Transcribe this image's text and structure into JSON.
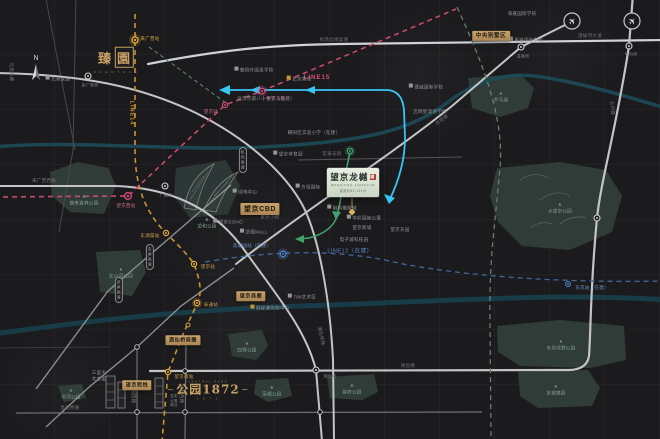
{
  "card": {
    "title": "望京龙樾",
    "eng": "WANGJING LONGYUE",
    "spec": "建面约89-134㎡",
    "seal": "樾"
  },
  "zhen": {
    "c1": "臻",
    "c2": "園",
    "sub": "Z H E N Y U A N"
  },
  "p1872": {
    "top": "CENTRAL PARK",
    "main": "公园1872",
    "sub": "1 8 7 2"
  },
  "compass": {
    "n": "N"
  },
  "colors": {
    "gold": "#c9962e",
    "pink": "#c94a74",
    "blue": "#40699f",
    "sage": "#5e8274",
    "cyan": "#38c5f5",
    "green": "#3fa46a",
    "tag_gold": "#bd9463",
    "brand_gold": "#c9a063",
    "park": "#33403c",
    "river": "#1c4e5c",
    "road_major": "#cfcfd2",
    "card_bg": "#dde5d4",
    "seal_red": "#b23a2e"
  },
  "labels": [
    {
      "n": "label-line15",
      "t": "LINE15",
      "x": 317,
      "y": 79,
      "c": "l15"
    },
    {
      "n": "label-line14",
      "t": "LINE14",
      "x": 131,
      "y": 113,
      "c": "l14",
      "r": 90
    },
    {
      "n": "label-line12",
      "t": "LINE12（在建）",
      "x": 350,
      "y": 252,
      "c": "l12"
    },
    {
      "n": "station-laiguangying",
      "t": "来广营站",
      "x": 150,
      "y": 39,
      "c": "sg"
    },
    {
      "n": "station-donghuqu",
      "t": "东湖渠站",
      "x": 150,
      "y": 236,
      "c": "sg"
    },
    {
      "n": "station-wangjing-l14",
      "t": "望京站",
      "x": 208,
      "y": 267,
      "c": "sg"
    },
    {
      "n": "station-futong",
      "t": "阜通站",
      "x": 211,
      "y": 305,
      "c": "sg"
    },
    {
      "n": "station-wangjingnan",
      "t": "望京南站",
      "x": 184,
      "y": 377,
      "c": "sg"
    },
    {
      "n": "station-wangjingxi",
      "t": "望京西站",
      "x": 126,
      "y": 206,
      "c": "sp"
    },
    {
      "n": "station-wangjing-l15",
      "t": "望京站",
      "x": 211,
      "y": 112,
      "c": "sp"
    },
    {
      "n": "station-wangjingdong",
      "t": "望京东站",
      "x": 276,
      "y": 99,
      "c": "sp"
    },
    {
      "n": "station-gaojiayuan",
      "t": "高家园站（在建）",
      "x": 252,
      "y": 246,
      "c": "sb"
    },
    {
      "n": "station-dongfeng",
      "t": "东风站（在建）",
      "x": 592,
      "y": 288,
      "c": "sb"
    },
    {
      "n": "junction-laiguangyingqiao",
      "t": "来广营桥",
      "x": 90,
      "y": 85,
      "c": "jct"
    },
    {
      "n": "junction-guangshunqiao",
      "t": "广顺桥",
      "x": 166,
      "y": 195,
      "c": "jct"
    },
    {
      "n": "junction-wenyuqiao",
      "t": "温榆桥",
      "x": 523,
      "y": 56,
      "c": "jct"
    },
    {
      "n": "junction-weigouqiao",
      "t": "苇沟桥",
      "x": 631,
      "y": 54,
      "c": "jct"
    },
    {
      "n": "junction-jiuxianqiao",
      "t": "酒仙桥",
      "x": 330,
      "y": 376,
      "c": "jct"
    },
    {
      "n": "road-jichangbeixian",
      "t": "机场北线高速",
      "x": 334,
      "y": 40,
      "c": "road"
    },
    {
      "n": "road-wenyuhedadao",
      "t": "温榆河大道",
      "x": 590,
      "y": 36,
      "c": "road"
    },
    {
      "n": "road-jimilu",
      "t": "京密路",
      "x": 442,
      "y": 120,
      "c": "road",
      "r": -37
    },
    {
      "n": "road-wuhuanlu",
      "t": "五环路",
      "x": 612,
      "y": 108,
      "c": "road",
      "r": 84
    },
    {
      "n": "road-jiangtailu",
      "t": "将台路",
      "x": 408,
      "y": 366,
      "c": "road"
    },
    {
      "n": "road-liangmaqiaolu",
      "t": "亮马桥路",
      "x": 70,
      "y": 408,
      "c": "road"
    },
    {
      "n": "road-fangyuanxilu",
      "t": "芳园西路",
      "x": 133,
      "y": 394,
      "c": "road",
      "r": 90
    },
    {
      "n": "road-jiangtaixilu",
      "t": "将台西路",
      "x": 181,
      "y": 394,
      "c": "road",
      "r": 90
    },
    {
      "n": "road-jiuxianqiaolu",
      "t": "酒仙桥路",
      "x": 321,
      "y": 336,
      "c": "road",
      "r": 78
    },
    {
      "n": "road-hongtaidongjie",
      "t": "宏泰东街",
      "x": 332,
      "y": 154,
      "c": "road"
    },
    {
      "n": "road-laiguangyingxilu",
      "t": "来广营西路",
      "x": 44,
      "y": 181,
      "c": "road"
    },
    {
      "n": "road-beiyuandonglu",
      "t": "北苑东路",
      "x": 11,
      "y": 72,
      "c": "road",
      "r": 90
    },
    {
      "n": "badge-jingchenggaosu-1",
      "t": "京承高速",
      "x": 150,
      "y": 257,
      "c": "badge"
    },
    {
      "n": "badge-jingchenggaosu-2",
      "t": "京承高速",
      "x": 119,
      "y": 290,
      "c": "badge"
    },
    {
      "n": "badge-jichanggaosu",
      "t": "机场高速",
      "x": 243,
      "y": 160,
      "c": "badge"
    },
    {
      "n": "poi-beiyuanjiayuan",
      "t": "北苑家园",
      "x": 58,
      "y": 79,
      "c": "poi",
      "i": "b"
    },
    {
      "n": "poi-chaowai-school",
      "t": "朝阳外国语学校",
      "x": 254,
      "y": 70,
      "c": "poi",
      "i": "b"
    },
    {
      "n": "poi-beijingxiangsong",
      "t": "北京香颂",
      "x": 299,
      "y": 79,
      "c": "poi",
      "i": "g"
    },
    {
      "n": "poi-bashizhong",
      "t": "北京市第八十中学（在建）",
      "x": 266,
      "y": 99,
      "c": "poi"
    },
    {
      "n": "poi-shiyanxiaoxue",
      "t": "朝阳区实验小学（在建）",
      "x": 314,
      "y": 133,
      "c": "poi"
    },
    {
      "n": "poi-dewei",
      "t": "德威国际学校",
      "x": 426,
      "y": 87,
      "c": "poi",
      "i": "b"
    },
    {
      "n": "poi-qimingxing",
      "t": "启明星双语学校",
      "x": 430,
      "y": 112,
      "c": "poi"
    },
    {
      "n": "poi-qingmiao",
      "t": "青苗国际学校",
      "x": 526,
      "y": 40,
      "c": "poi",
      "i": "b"
    },
    {
      "n": "poi-haijia",
      "t": "海嘉国际学校",
      "x": 522,
      "y": 14,
      "c": "poi"
    },
    {
      "n": "poi-wangjingsoho",
      "t": "望京SOHO",
      "x": 228,
      "y": 222,
      "c": "poi",
      "i": "b"
    },
    {
      "n": "poi-lvdizhongxin",
      "t": "绿地中心",
      "x": 245,
      "y": 192,
      "c": "poi",
      "i": "b"
    },
    {
      "n": "poi-kaidemall",
      "t": "凯德MALL",
      "x": 254,
      "y": 232,
      "c": "poi",
      "i": "b"
    },
    {
      "n": "poi-fangheng",
      "t": "方恒国际",
      "x": 308,
      "y": 187,
      "c": "poi",
      "i": "b"
    },
    {
      "n": "poi-wangjingxiaojie",
      "t": "望京小街",
      "x": 270,
      "y": 217,
      "c": "poi"
    },
    {
      "n": "poi-rongke",
      "t": "融科橄榄城",
      "x": 342,
      "y": 208,
      "c": "poi",
      "i": "b"
    },
    {
      "n": "poi-huacai",
      "t": "华彩国际公寓",
      "x": 364,
      "y": 218,
      "c": "poi",
      "i": "b"
    },
    {
      "n": "poi-wangjingxincheng",
      "t": "望京新城",
      "x": 362,
      "y": 228,
      "c": "poi"
    },
    {
      "n": "poi-wangjingdongyuan",
      "t": "望京东园",
      "x": 400,
      "y": 230,
      "c": "poi"
    },
    {
      "n": "poi-dianzicheng",
      "t": "电子城科技园",
      "x": 354,
      "y": 240,
      "c": "poi"
    },
    {
      "n": "poi-wangjingtiyuyuan",
      "t": "望京体育园",
      "x": 288,
      "y": 154,
      "c": "poi",
      "i": "b"
    },
    {
      "n": "poi-yidigang",
      "t": "颐堤港购物中心",
      "x": 270,
      "y": 308,
      "c": "poi",
      "i": "g"
    },
    {
      "n": "poi-798",
      "t": "798艺术区",
      "x": 302,
      "y": 297,
      "c": "poi",
      "i": "b"
    },
    {
      "n": "poi-sanlitun",
      "t": "三里屯\n太古里",
      "x": 99,
      "y": 376,
      "c": "poi"
    },
    {
      "n": "poi-towers-caption",
      "t": "住宅\n公寓\n商业",
      "x": 174,
      "y": 401,
      "c": "poi",
      "s": 3.5
    },
    {
      "n": "park-chaolai",
      "t": "朝来森林公园",
      "x": 84,
      "y": 200,
      "c": "park"
    },
    {
      "n": "park-beixiaohe",
      "t": "北小河公园",
      "x": 121,
      "y": 273,
      "c": "park"
    },
    {
      "n": "park-wanghe",
      "t": "望和公园",
      "x": 207,
      "y": 223,
      "c": "park"
    },
    {
      "n": "park-dawangjing",
      "t": "大望京公园",
      "x": 560,
      "y": 208,
      "c": "park"
    },
    {
      "n": "park-luomahu",
      "t": "罗马湖",
      "x": 501,
      "y": 97,
      "c": "park"
    },
    {
      "n": "park-dongba",
      "t": "东坝郊野公园",
      "x": 561,
      "y": 345,
      "c": "park"
    },
    {
      "n": "park-jingchenghuaiyuan",
      "t": "京城槐园",
      "x": 556,
      "y": 390,
      "c": "park"
    },
    {
      "n": "park-side",
      "t": "四得公园",
      "x": 247,
      "y": 347,
      "c": "park"
    },
    {
      "n": "park-jiangfu",
      "t": "将府公园",
      "x": 352,
      "y": 389,
      "c": "park"
    },
    {
      "n": "park-lidu",
      "t": "丽都公园",
      "x": 272,
      "y": 391,
      "c": "park"
    },
    {
      "n": "park-bahe",
      "t": "坝河公园",
      "x": 71,
      "y": 394,
      "c": "park"
    },
    {
      "n": "tag-zhongyangbieshuqu",
      "t": "中央别墅区",
      "x": 491,
      "y": 36,
      "c": "tag",
      "s": 5.5
    },
    {
      "n": "tag-wangjingcbd",
      "t": "望京CBD",
      "x": 260,
      "y": 209,
      "c": "tag",
      "s": 7
    },
    {
      "n": "tag-wangjingxiyue",
      "t": "望京熙悦",
      "x": 137,
      "y": 385,
      "c": "tag",
      "s": 5
    },
    {
      "n": "tag-wangjingshangquan",
      "t": "望京商圈",
      "x": 251,
      "y": 296,
      "c": "tag",
      "s": 5
    },
    {
      "n": "tag-jiuxianqiaoshangquan",
      "t": "酒仙桥商圈",
      "x": 183,
      "y": 340,
      "c": "tag",
      "s": 5
    }
  ]
}
